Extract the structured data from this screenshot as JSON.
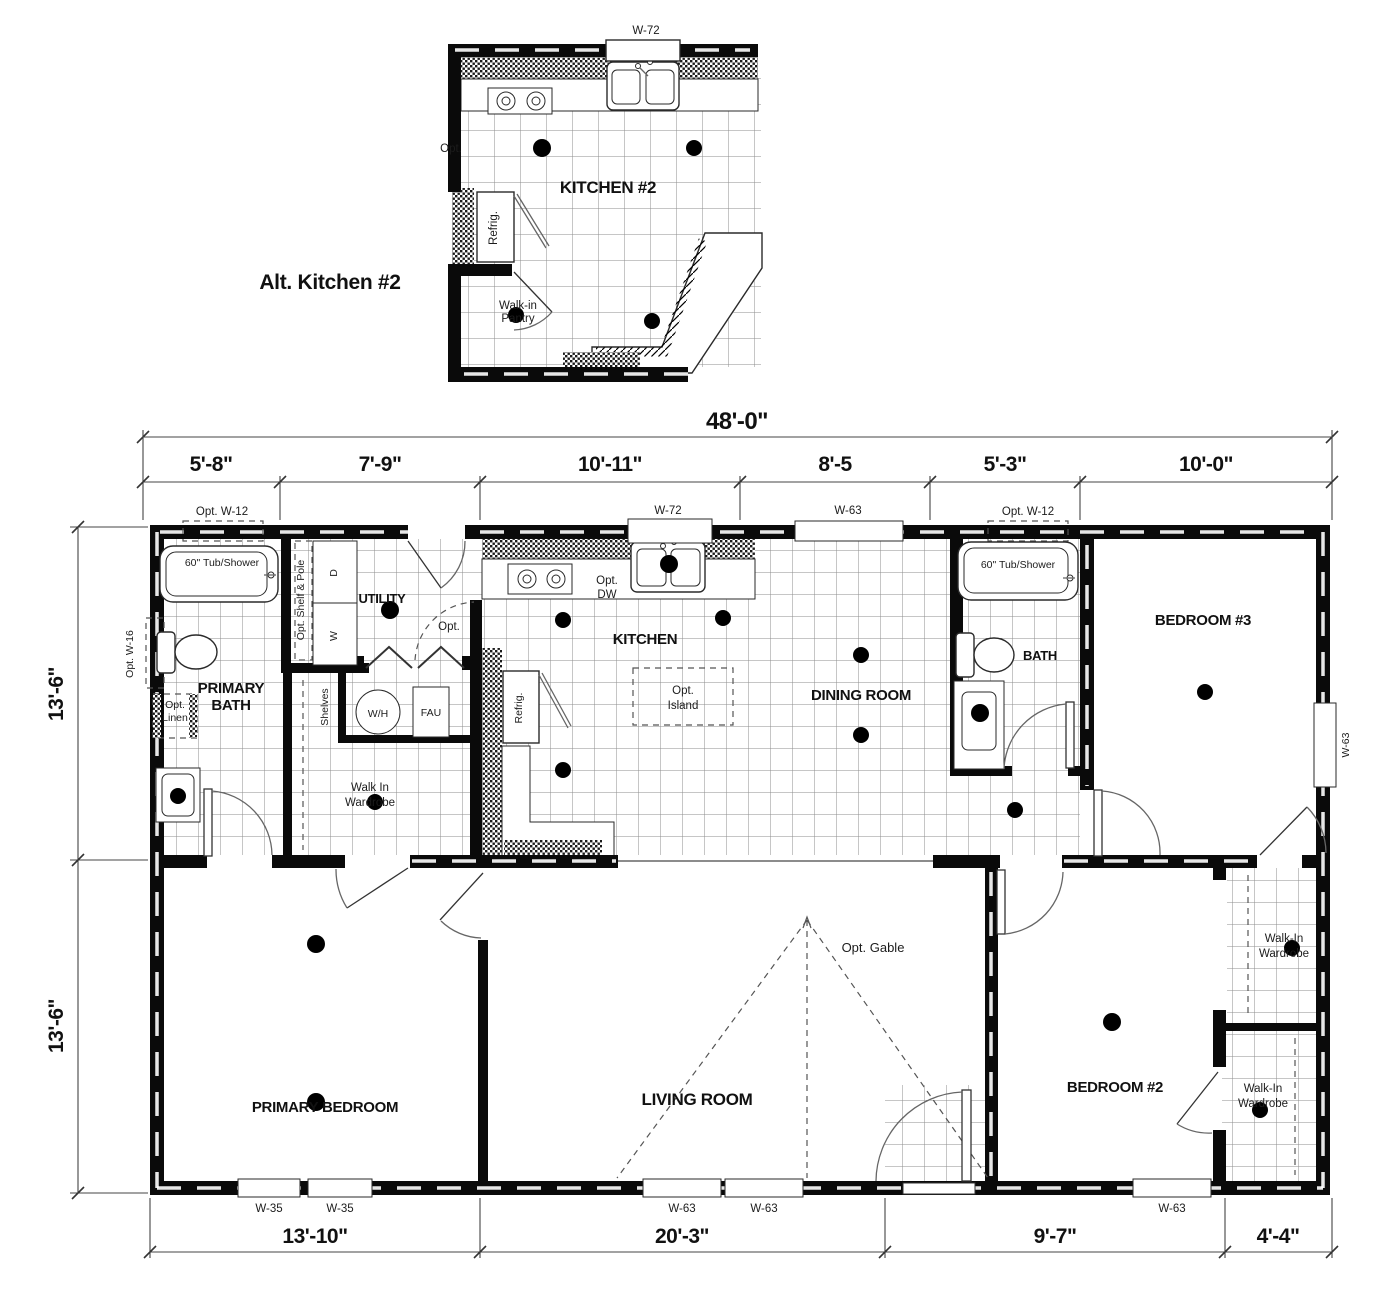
{
  "inset": {
    "title": "Alt. Kitchen #2",
    "window_top": "W-72",
    "room": "KITCHEN #2",
    "opt": "Opt.",
    "refrig": "Refrig.",
    "pantry_l1": "Walk-in",
    "pantry_l2": "Pantry"
  },
  "dims": {
    "total": "48'-0\"",
    "top": [
      "5'-8\"",
      "7'-9\"",
      "10'-11\"",
      "8'-5",
      "5'-3\"",
      "10'-0\""
    ],
    "left_upper": "13'-6\"",
    "left_lower": "13'-6\"",
    "bottom": [
      "13'-10\"",
      "20'-3\"",
      "9'-7\"",
      "4'-4\""
    ]
  },
  "windows": {
    "top_opt_w12_left": "Opt. W-12",
    "top_w72": "W-72",
    "top_w63": "W-63",
    "top_opt_w12_right": "Opt. W-12",
    "left_opt_w16": "Opt. W-16",
    "right_w63": "W-63",
    "bottom_w35_1": "W-35",
    "bottom_w35_2": "W-35",
    "bottom_w63_1": "W-63",
    "bottom_w63_2": "W-63",
    "bottom_w63_3": "W-63"
  },
  "rooms": {
    "primary_bath_l1": "PRIMARY",
    "primary_bath_l2": "BATH",
    "utility": "UTILITY",
    "kitchen": "KITCHEN",
    "dining": "DINING ROOM",
    "bath": "BATH",
    "bedroom3": "BEDROOM #3",
    "primary_bedroom": "PRIMARY BEDROOM",
    "living": "LIVING ROOM",
    "bedroom2": "BEDROOM #2",
    "wardrobe_l1": "Walk In",
    "wardrobe_l2": "Wardrobe",
    "wiw_upper_l1": "Walk-In",
    "wiw_upper_l2": "Wardrobe",
    "wiw_lower_l1": "Walk-In",
    "wiw_lower_l2": "Wardrobe"
  },
  "fixtures": {
    "tub1": "60\" Tub/Shower",
    "tub2": "60\" Tub/Shower",
    "opt_linen_l1": "Opt.",
    "opt_linen_l2": "Linen",
    "shelf_pole": "Opt. Shelf & Pole",
    "dryer": "D",
    "washer": "W",
    "water_heater": "W/H",
    "fau": "FAU",
    "shelves": "Shelves",
    "refrig": "Refrig.",
    "opt_dw_l1": "Opt.",
    "opt_dw_l2": "DW",
    "opt_island_l1": "Opt.",
    "opt_island_l2": "Island",
    "opt_kitchen": "Opt.",
    "opt_gable": "Opt. Gable"
  },
  "colors": {
    "wall": "#0a0a0a",
    "line": "#444444",
    "tile": "#8d8d8d"
  }
}
